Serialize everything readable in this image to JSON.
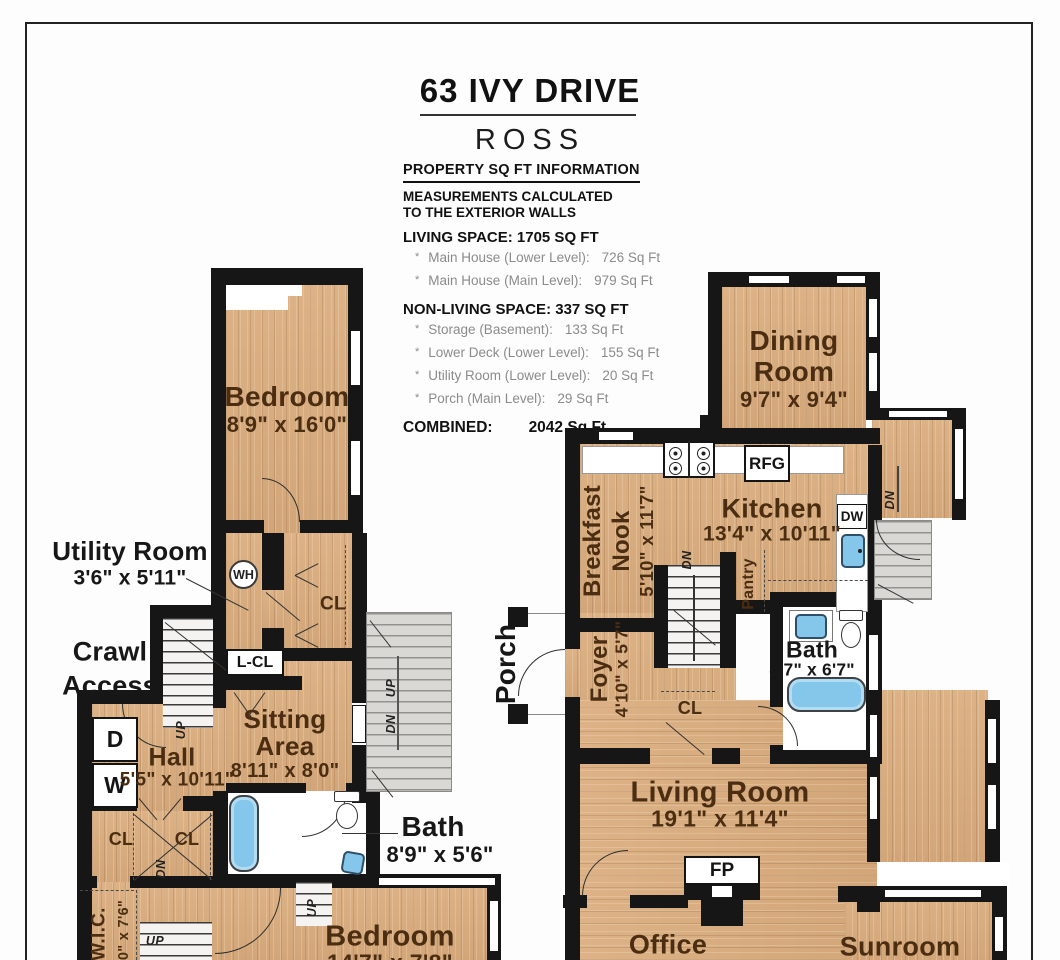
{
  "header": {
    "title": "63 IVY DRIVE",
    "subtitle": "ROSS",
    "section_title": "PROPERTY SQ FT INFORMATION",
    "measurement_note": [
      "MEASUREMENTS CALCULATED",
      "TO THE EXTERIOR WALLS"
    ],
    "living_space_heading": "LIVING SPACE: 1705 SQ FT",
    "living_space_items": [
      {
        "bullet": "*",
        "label": "Main House (Lower Level):",
        "value": "726 Sq Ft"
      },
      {
        "bullet": "*",
        "label": "Main House (Main Level):",
        "value": "979 Sq Ft"
      }
    ],
    "non_living_heading": "NON-LIVING SPACE: 337 SQ FT",
    "non_living_items": [
      {
        "bullet": "*",
        "label": "Storage (Basement):",
        "value": "133 Sq Ft"
      },
      {
        "bullet": "*",
        "label": "Lower Deck (Lower Level):",
        "value": "155 Sq Ft"
      },
      {
        "bullet": "*",
        "label": "Utility Room (Lower Level):",
        "value": "20 Sq Ft"
      },
      {
        "bullet": "*",
        "label": "Porch (Main Level):",
        "value": "29 Sq Ft"
      }
    ],
    "combined_label": "COMBINED:",
    "combined_value": "2042  Sq Ft"
  },
  "lower_level": {
    "bedroom_upper": {
      "name": "Bedroom",
      "dims": "8'9\" x 16'0\""
    },
    "utility_room": {
      "name": "Utility Room",
      "dims": "3'6\" x 5'11\""
    },
    "water_heater": "WH",
    "closet_upper": "CL",
    "linen_closet": "L-CL",
    "crawl_access": [
      "Crawl",
      "Access"
    ],
    "hall": {
      "name": "Hall",
      "dims": "5'5\" x 10'11\""
    },
    "sitting_area": {
      "name": [
        "Sitting",
        "Area"
      ],
      "dims": "8'11\" x 8'0\""
    },
    "dryer": "D",
    "washer": "W",
    "closet_left_a": "CL",
    "closet_left_b": "CL",
    "bath": {
      "name": "Bath",
      "dims": "8'9\" x 5'6\""
    },
    "bedroom_lower": {
      "name": "Bedroom",
      "dims": "14'7\" x 7'8\""
    },
    "wic": {
      "name": "W.I.C.",
      "dims": "0\" x 7'6\""
    },
    "markers": {
      "up": "UP",
      "dn": "DN"
    }
  },
  "main_level": {
    "dining_room": {
      "name": [
        "Dining",
        "Room"
      ],
      "dims": "9'7\" x 9'4\""
    },
    "kitchen": {
      "name": "Kitchen",
      "dims": "13'4\" x 10'11\""
    },
    "breakfast_nook": {
      "name": [
        "Breakfast",
        "Nook"
      ],
      "dims": "5'10\" x 11'7\""
    },
    "refrigerator": "RFG",
    "dishwasher": "DW",
    "pantry": "Pantry",
    "porch": "Porch",
    "foyer": {
      "name": "Foyer",
      "dims": "4'10\" x 5'7\""
    },
    "closet": "CL",
    "bath": {
      "name": "Bath",
      "dims": "8'7\" x 6'7\""
    },
    "living_room": {
      "name": "Living Room",
      "dims": "19'1\" x 11'4\""
    },
    "fireplace": "FP",
    "office": "Office",
    "sunroom": "Sunroom",
    "markers": {
      "up": "UP",
      "dn": "DN"
    }
  },
  "colors": {
    "wood": "#d8ad7f",
    "wall": "#161616",
    "fixture_blue": "#84c7ea"
  }
}
